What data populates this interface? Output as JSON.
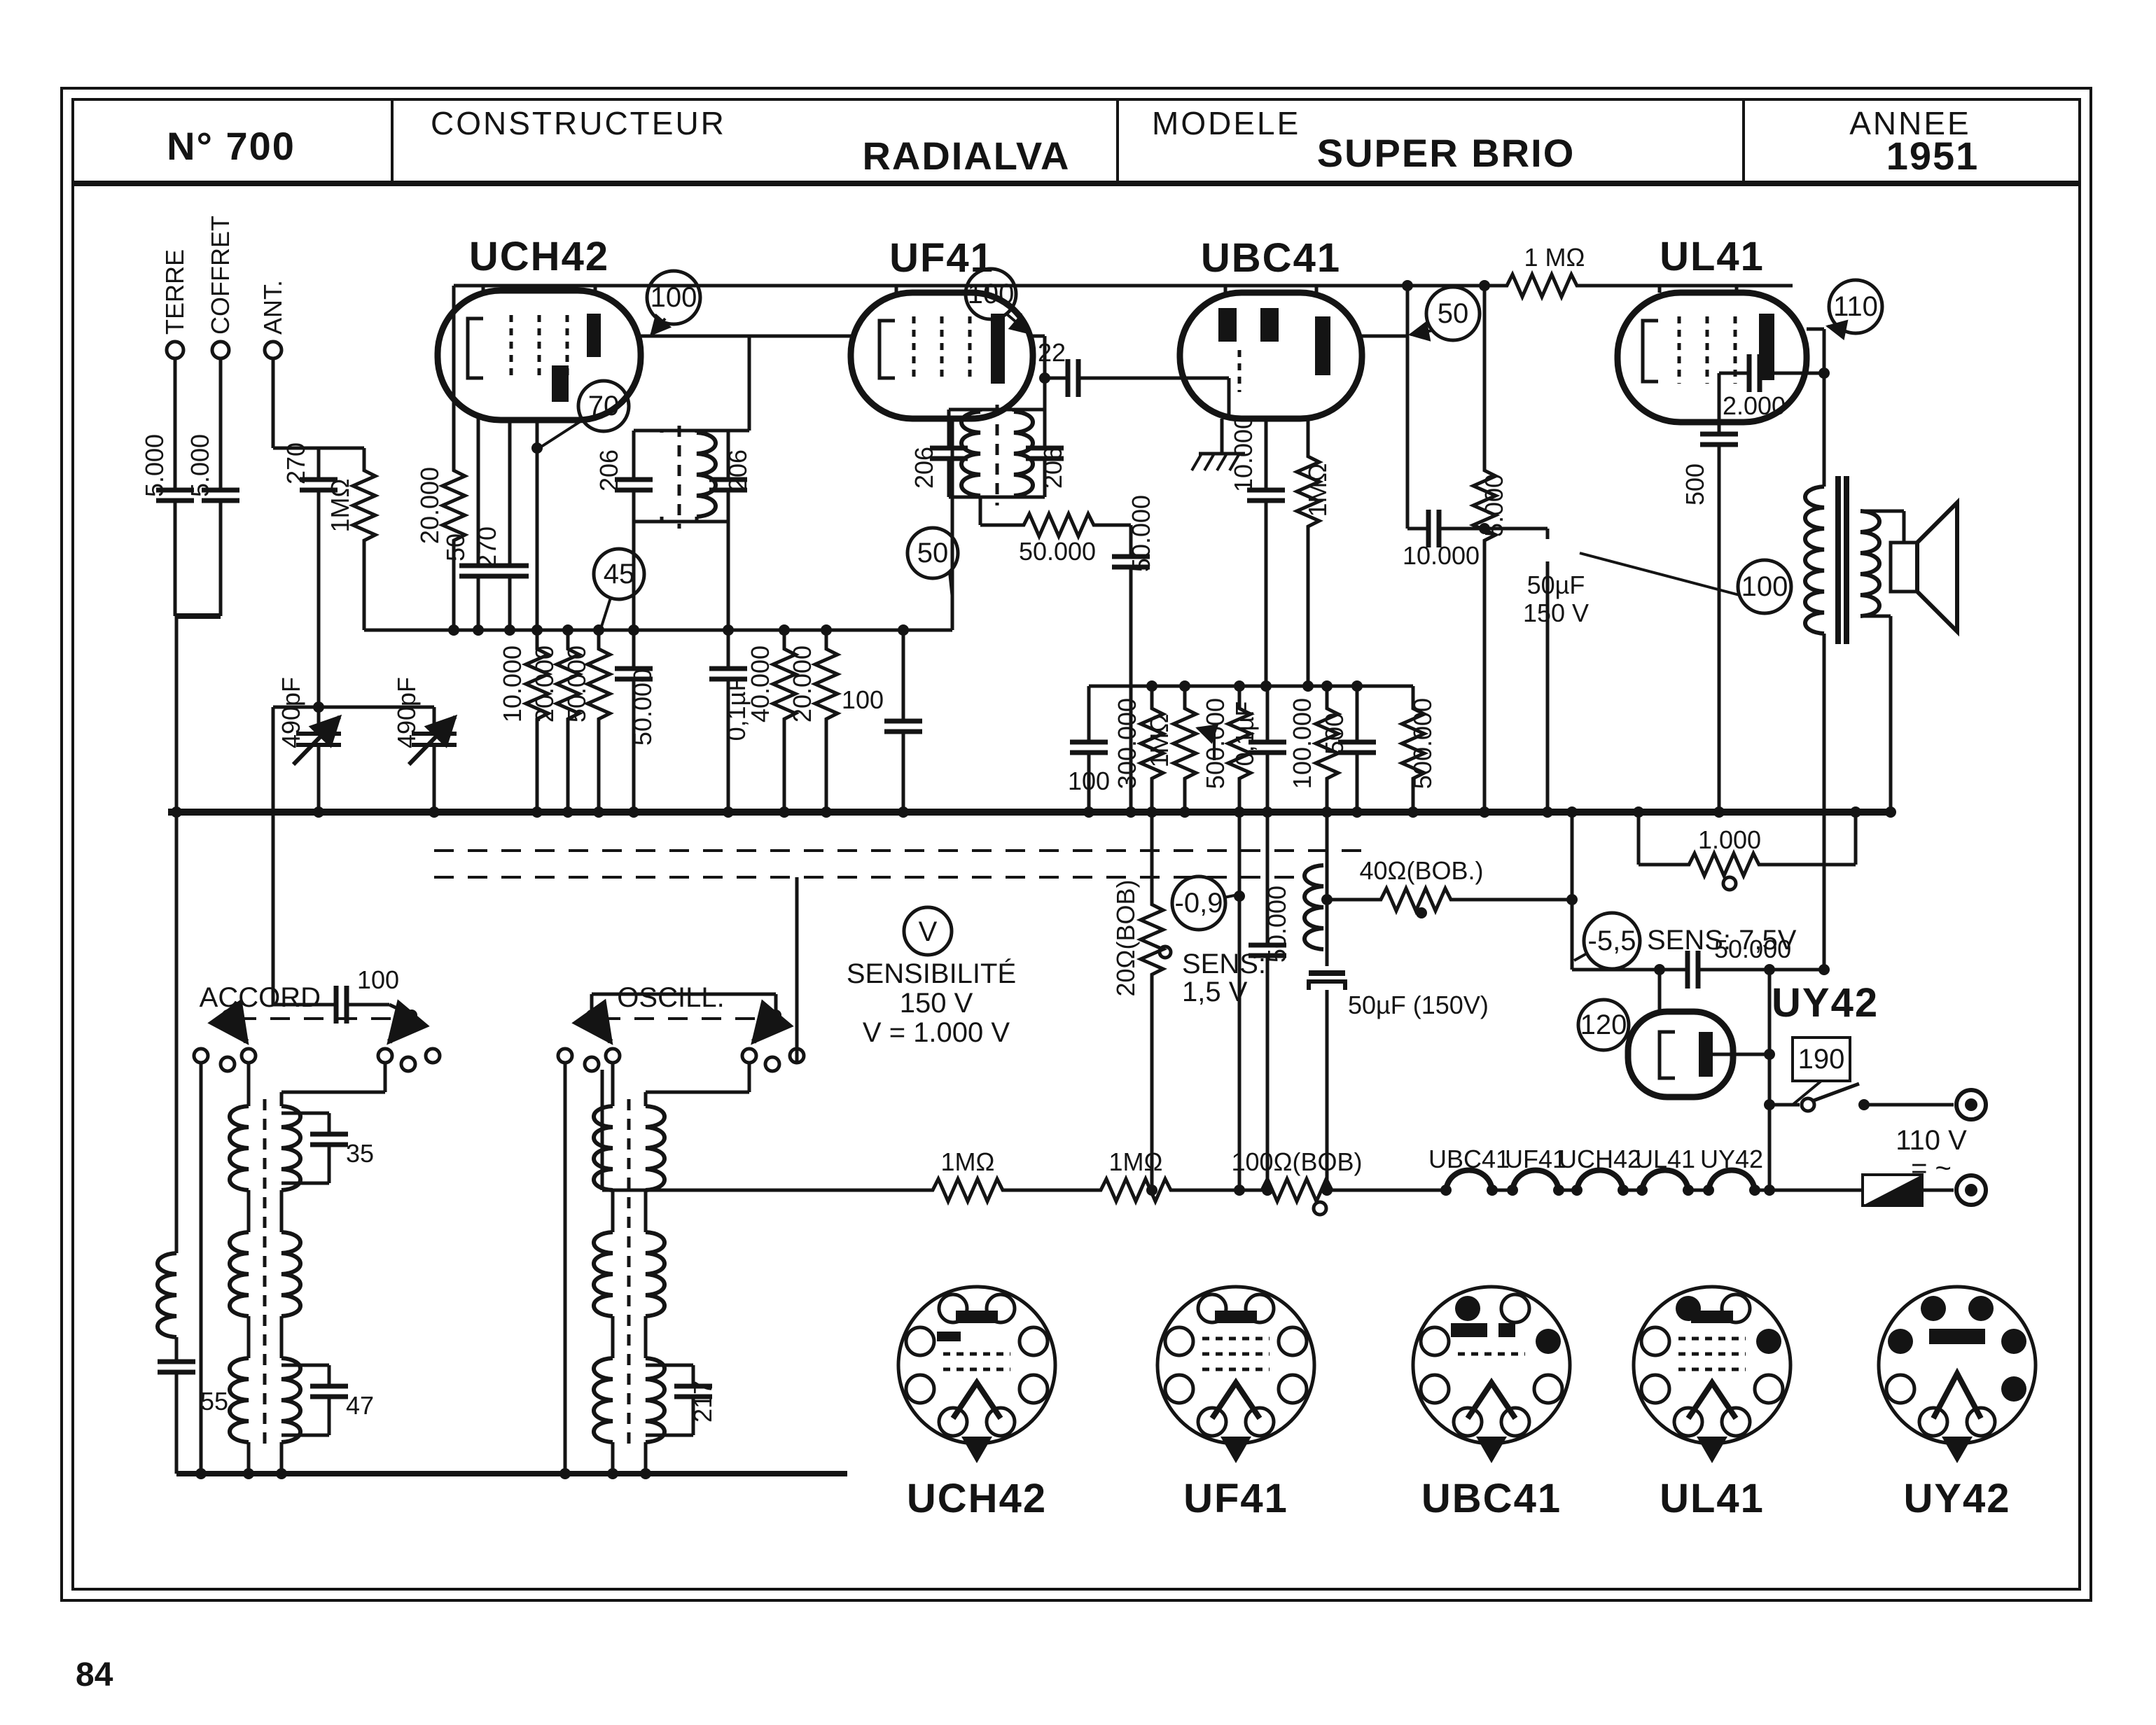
{
  "header": {
    "number": "N° 700",
    "constructeur_label": "CONSTRUCTEUR",
    "constructeur_value": "RADIALVA",
    "modele_label": "MODELE",
    "modele_value": "SUPER BRIO",
    "annee_label": "ANNEE",
    "annee_value": "1951"
  },
  "misc": {
    "page_number": "84"
  },
  "terminals": {
    "terre": "TERRE",
    "coffret": "COFFRET",
    "ant": "ANT.",
    "mains": "110 V",
    "acdc": "= ~"
  },
  "tubes": {
    "uch42": "UCH42",
    "uf41": "UF41",
    "ubc41": "UBC41",
    "ul41": "UL41",
    "uy42": "UY42"
  },
  "switches": {
    "accord": "ACCORD",
    "oscill": "OSCILL."
  },
  "filaments": [
    "UBC41",
    "UF41",
    "UCH42",
    "UL41",
    "UY42"
  ],
  "pinouts": [
    "UCH42",
    "UF41",
    "UBC41",
    "UL41",
    "UY42"
  ],
  "callouts": {
    "vmeter": "V",
    "uch_plate": "100",
    "uch_screen": "70",
    "uch_osc": "45",
    "uf_plate": "100",
    "uf_screen": "50",
    "ubc_plate": "50",
    "ul_plate": "110",
    "ul_cath": "100",
    "uy_out": "120",
    "uy_in": "190",
    "g_ubc": "-0,9",
    "g_ul": "-5,5"
  },
  "notes": {
    "sens1": "SENSIBILITÉ",
    "sens2": "150 V",
    "sens3": "V = 1.000  V",
    "sens4": "SENS:",
    "sens5": "1,5 V",
    "sens6": "SENS: 7,5V"
  },
  "values": {
    "c_in1": "5.000",
    "c_in2": "5.000",
    "c_ant": "270",
    "r_leak": "1MΩ",
    "cv1": "490pF",
    "cv2": "490pF",
    "r_20k_a": "20.000",
    "c_50": "50",
    "c_270": "270",
    "r_10k": "10.000",
    "r_20k_b": "20.000",
    "r_50k": "50.000",
    "c_50k_a": "50.000",
    "c_01_a": "0,1µF",
    "if1_c1": "206",
    "if1_c2": "206",
    "if2_c1": "206",
    "if2_c2": "206",
    "r_40k": "40.000",
    "r_20k_c": "20.000",
    "c_100_a": "100",
    "c_22": "22",
    "r_50k_h": "50.000",
    "c_50k_b": "50.000",
    "c_10k_a": "10.000",
    "r_1m_b": "1MΩ",
    "c_100_b": "100",
    "r_300k": "300.000",
    "r_pot": "1MΩ",
    "r_500k_a": "500.000",
    "c_01_b": "0,1µF",
    "r_100k": "100.000",
    "c_500_a": "500",
    "r_500k_b": "500.000",
    "r_1m_top": "1 MΩ",
    "c_10k_b": "10.000",
    "r_5k": "5.000",
    "e1_l1": "50µF",
    "e1_l2": "150 V",
    "c_2000": "2.000",
    "c_500_b": "500",
    "r_1000": "1.000",
    "r_20bob": "20Ω(BOB)",
    "c_50k_c": "50.000",
    "r_1m_e": "1MΩ",
    "r_1m_f": "1MΩ",
    "r_100bob": "100Ω(BOB)",
    "r_40bob": "40Ω(BOB.)",
    "e2": "50µF (150V)",
    "c_50k_d": "50.000",
    "t_35": "35",
    "t_47": "47",
    "t_217": "217",
    "c_55": "55",
    "c_100_c": "100"
  }
}
